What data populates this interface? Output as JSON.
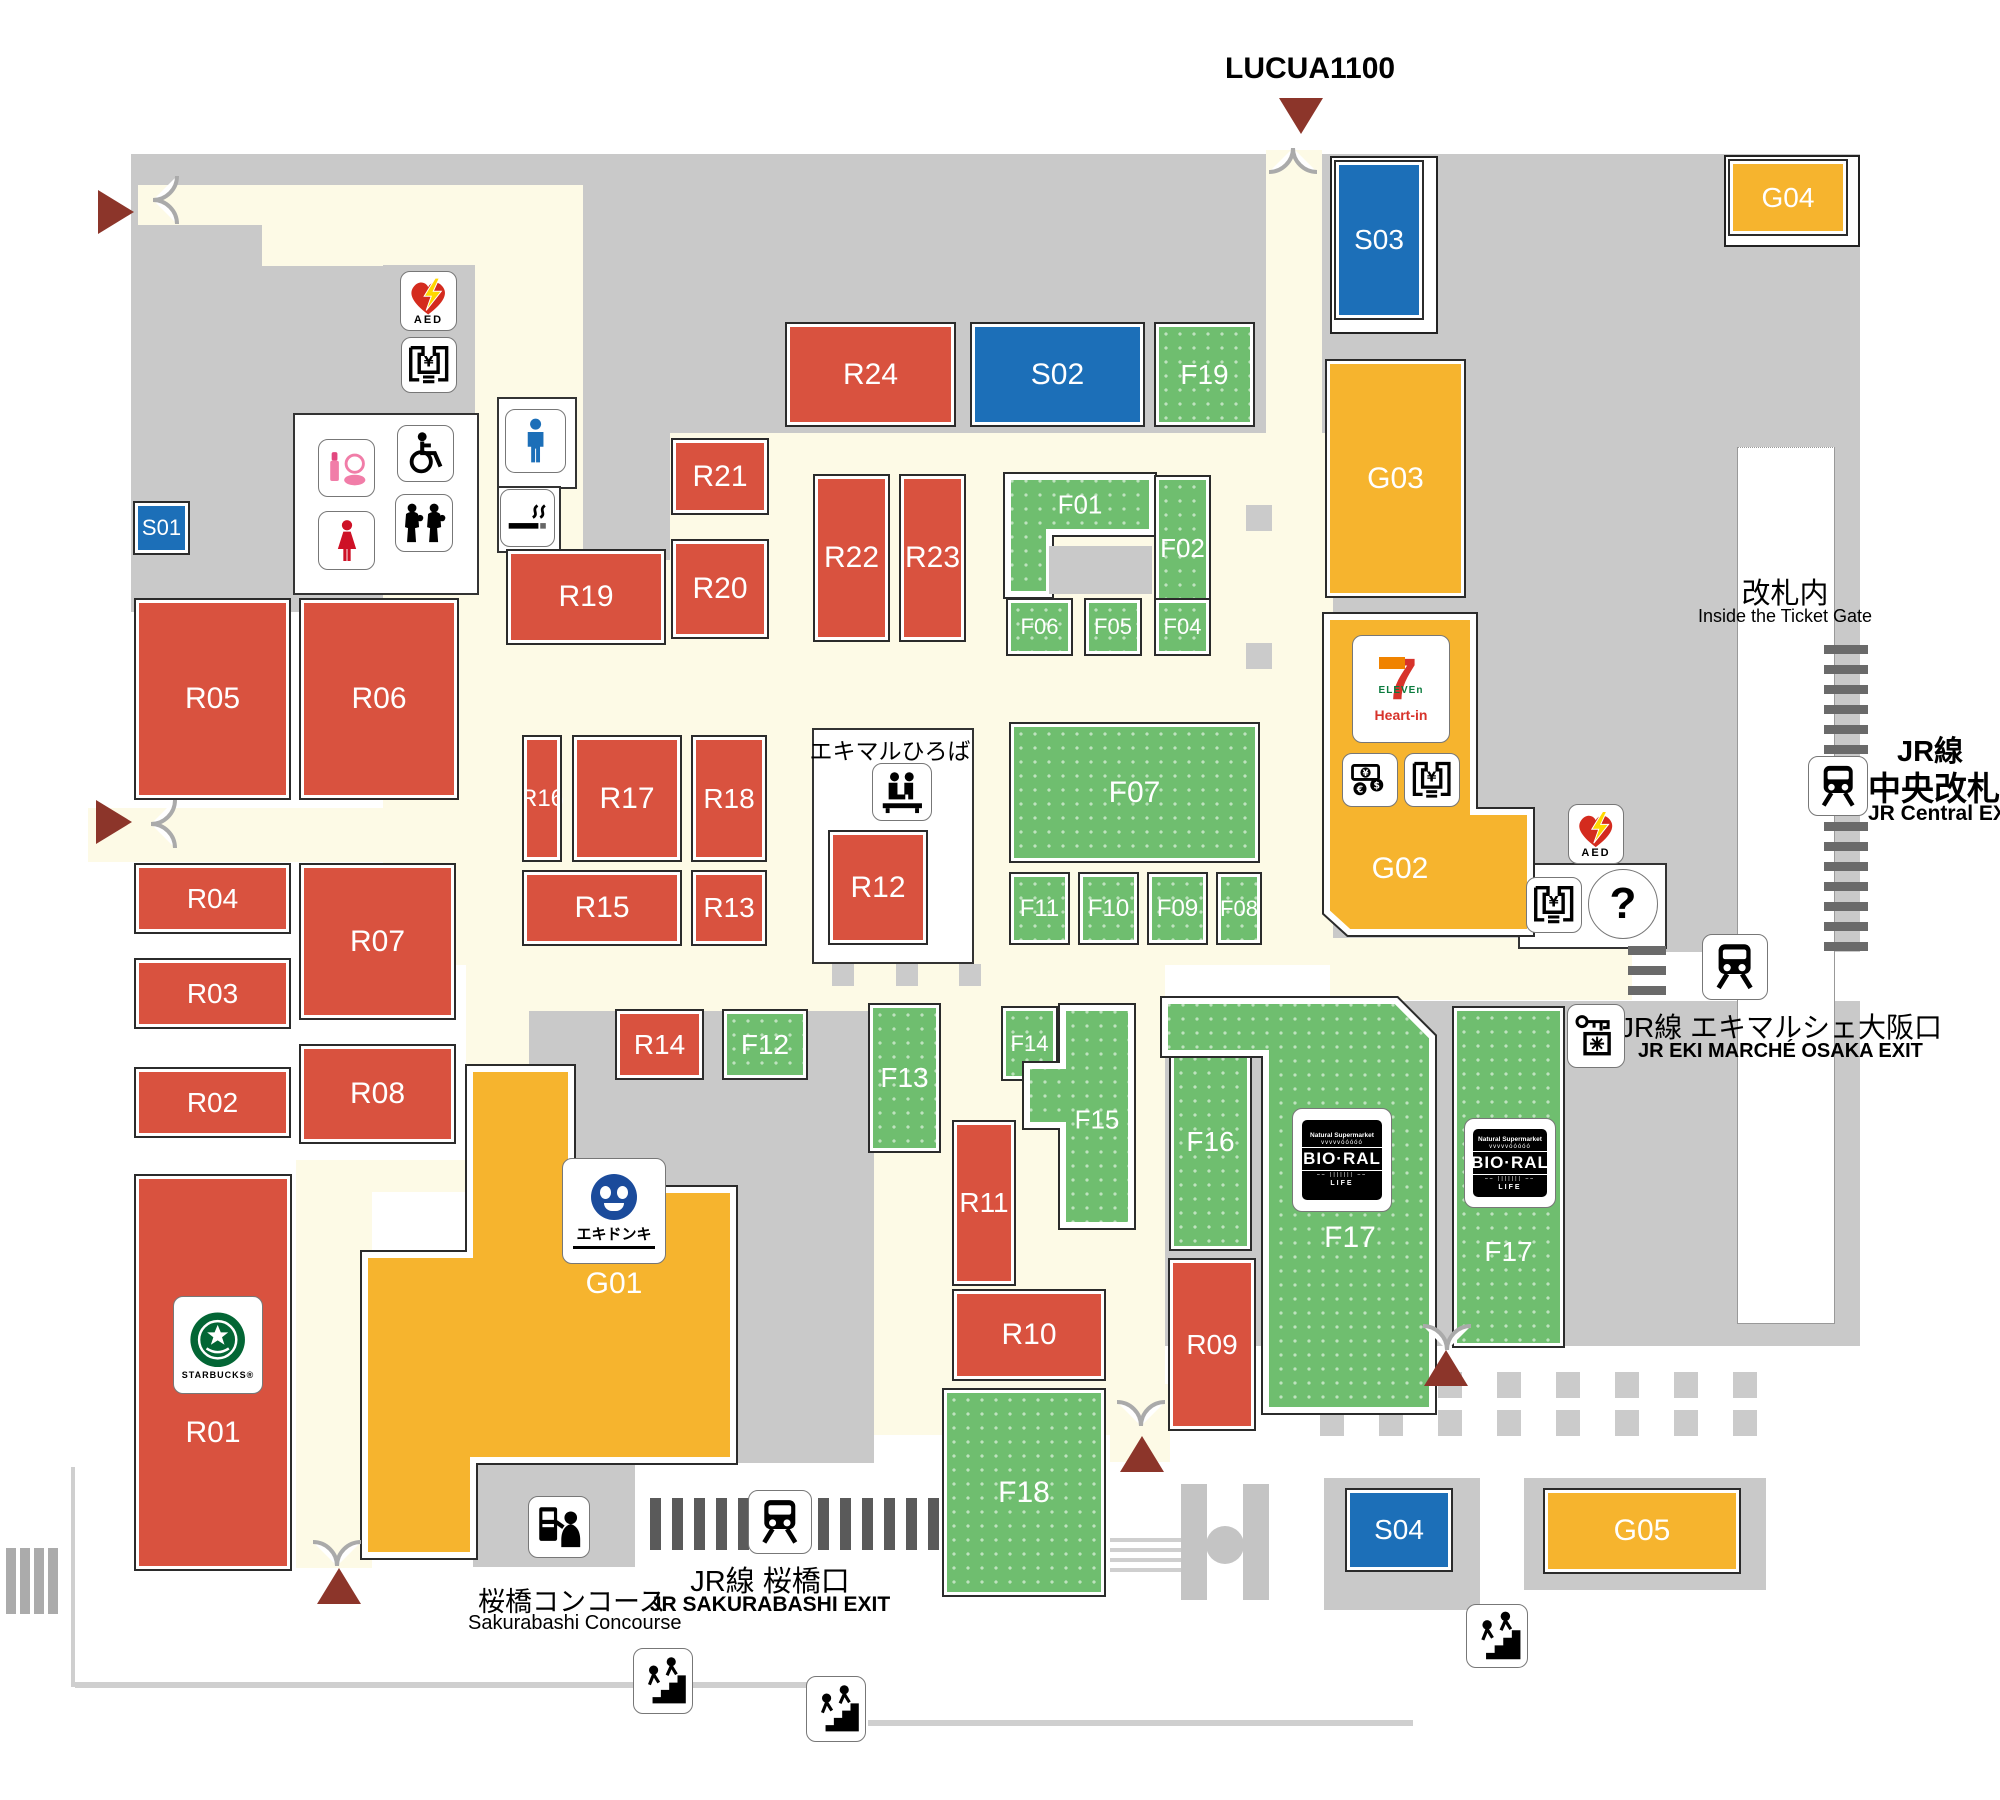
{
  "map": {
    "blocks": [
      {
        "id": "R01",
        "label": "R01",
        "group": "R"
      },
      {
        "id": "R02",
        "label": "R02",
        "group": "R"
      },
      {
        "id": "R03",
        "label": "R03",
        "group": "R"
      },
      {
        "id": "R04",
        "label": "R04",
        "group": "R"
      },
      {
        "id": "R05",
        "label": "R05",
        "group": "R"
      },
      {
        "id": "R06",
        "label": "R06",
        "group": "R"
      },
      {
        "id": "R07",
        "label": "R07",
        "group": "R"
      },
      {
        "id": "R08",
        "label": "R08",
        "group": "R"
      },
      {
        "id": "R09",
        "label": "R09",
        "group": "R"
      },
      {
        "id": "R10",
        "label": "R10",
        "group": "R"
      },
      {
        "id": "R11",
        "label": "R11",
        "group": "R"
      },
      {
        "id": "R12",
        "label": "R12",
        "group": "R"
      },
      {
        "id": "R13",
        "label": "R13",
        "group": "R"
      },
      {
        "id": "R14",
        "label": "R14",
        "group": "R"
      },
      {
        "id": "R15",
        "label": "R15",
        "group": "R"
      },
      {
        "id": "R16",
        "label": "R16",
        "group": "R"
      },
      {
        "id": "R17",
        "label": "R17",
        "group": "R"
      },
      {
        "id": "R18",
        "label": "R18",
        "group": "R"
      },
      {
        "id": "R19",
        "label": "R19",
        "group": "R"
      },
      {
        "id": "R20",
        "label": "R20",
        "group": "R"
      },
      {
        "id": "R21",
        "label": "R21",
        "group": "R"
      },
      {
        "id": "R22",
        "label": "R22",
        "group": "R"
      },
      {
        "id": "R23",
        "label": "R23",
        "group": "R"
      },
      {
        "id": "R24",
        "label": "R24",
        "group": "R"
      },
      {
        "id": "F01",
        "label": "F01",
        "group": "F"
      },
      {
        "id": "F02",
        "label": "F02",
        "group": "F"
      },
      {
        "id": "F04",
        "label": "F04",
        "group": "F"
      },
      {
        "id": "F05",
        "label": "F05",
        "group": "F"
      },
      {
        "id": "F06",
        "label": "F06",
        "group": "F"
      },
      {
        "id": "F07",
        "label": "F07",
        "group": "F"
      },
      {
        "id": "F08",
        "label": "F08",
        "group": "F"
      },
      {
        "id": "F09",
        "label": "F09",
        "group": "F"
      },
      {
        "id": "F10",
        "label": "F10",
        "group": "F"
      },
      {
        "id": "F11",
        "label": "F11",
        "group": "F"
      },
      {
        "id": "F12",
        "label": "F12",
        "group": "F"
      },
      {
        "id": "F13",
        "label": "F13",
        "group": "F"
      },
      {
        "id": "F14",
        "label": "F14",
        "group": "F"
      },
      {
        "id": "F15",
        "label": "F15",
        "group": "F"
      },
      {
        "id": "F16",
        "label": "F16",
        "group": "F"
      },
      {
        "id": "F17",
        "label": "F17",
        "group": "F"
      },
      {
        "id": "F17b",
        "label": "F17",
        "group": "F"
      },
      {
        "id": "F18",
        "label": "F18",
        "group": "F"
      },
      {
        "id": "F19",
        "label": "F19",
        "group": "F"
      },
      {
        "id": "G01",
        "label": "G01",
        "group": "G"
      },
      {
        "id": "G02",
        "label": "G02",
        "group": "G"
      },
      {
        "id": "G03",
        "label": "G03",
        "group": "G"
      },
      {
        "id": "G04",
        "label": "G04",
        "group": "G"
      },
      {
        "id": "G05",
        "label": "G05",
        "group": "G"
      },
      {
        "id": "S01",
        "label": "S01",
        "group": "S"
      },
      {
        "id": "S02",
        "label": "S02",
        "group": "S"
      },
      {
        "id": "S03",
        "label": "S03",
        "group": "S"
      },
      {
        "id": "S04",
        "label": "S04",
        "group": "S"
      }
    ],
    "exits": {
      "lucua": {
        "label": "LUCUA1100"
      },
      "jr_central": {
        "jp1": "JR線",
        "jp2": "中央改札口",
        "en": "JR Central EXIT"
      },
      "inside_gate": {
        "jp": "改札内",
        "en": "Inside the Ticket Gate"
      },
      "eki_marche": {
        "jp": "JR線 エキマルシェ大阪口",
        "en": "JR EKI MARCHÉ OSAKA EXIT"
      },
      "sakurabashi": {
        "jp": "JR線 桜橋口",
        "en": "JR SAKURABASHI EXIT"
      },
      "concourse": {
        "jp": "桜橋コンコース",
        "en": "Sakurabashi Concourse"
      }
    },
    "areas": {
      "hiroba": "エキマルひろば"
    },
    "logos": {
      "starbucks": {
        "name": "STARBUCKS®"
      },
      "seven_eleven": {
        "seven": "7",
        "eleven": "ELEVEn",
        "heart_in": "Heart-in"
      },
      "bio_ral": {
        "tag": "Natural Supermarket",
        "name": "BIO-RAL",
        "life": "LIFE"
      },
      "eki_donki": {
        "name": "エキドンキ"
      }
    },
    "icon_labels": {
      "aed": "AED",
      "atm": "¥",
      "info": "?"
    },
    "colors": {
      "red": "#D9523F",
      "green": "#6FBE6F",
      "yellow": "#F6B42E",
      "blue": "#1C6FB8",
      "corridor": "#FDFAE6",
      "building": "#C9C9C9",
      "arrow": "#8C352A",
      "gate_dash": "#5F5F5F"
    }
  }
}
